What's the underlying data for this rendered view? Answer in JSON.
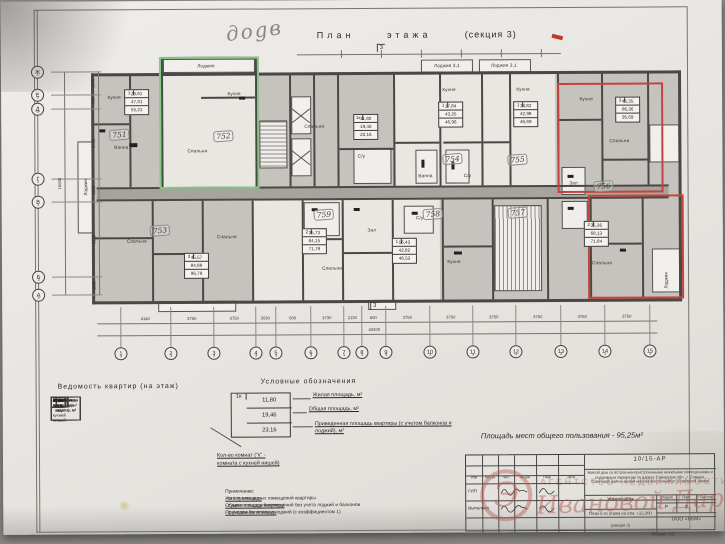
{
  "photo": {
    "handwritten_mark": "доgв"
  },
  "title": {
    "main": "План этажа",
    "section": "(секция 3)"
  },
  "plan": {
    "axis_sub": "3",
    "section_mark": "3",
    "room_labels": [
      {
        "x": 113,
        "y": 96,
        "t": "Кухня"
      },
      {
        "x": 205,
        "y": 65,
        "t": "Лоджия"
      },
      {
        "x": 233,
        "y": 93,
        "t": "Кухня"
      },
      {
        "x": 196,
        "y": 150,
        "t": "Спальня"
      },
      {
        "x": 313,
        "y": 126,
        "t": "Спальня"
      },
      {
        "x": 446,
        "y": 66,
        "t": "Лоджия 3,1"
      },
      {
        "x": 503,
        "y": 66,
        "t": "Лоджия 3,1"
      },
      {
        "x": 448,
        "y": 90,
        "t": "Кухня"
      },
      {
        "x": 522,
        "y": 90,
        "t": "Кухня"
      },
      {
        "x": 585,
        "y": 100,
        "t": "Кухня"
      },
      {
        "x": 618,
        "y": 142,
        "t": "Спальня"
      },
      {
        "x": 572,
        "y": 184,
        "t": "Зал"
      },
      {
        "x": 120,
        "y": 146,
        "t": "Ванна"
      },
      {
        "x": 360,
        "y": 156,
        "t": "С/у"
      },
      {
        "x": 424,
        "y": 176,
        "t": "Ванна"
      },
      {
        "x": 466,
        "y": 176,
        "t": "С/у"
      },
      {
        "x": 135,
        "y": 240,
        "t": "Спальня"
      },
      {
        "x": 225,
        "y": 236,
        "t": "Спальня"
      },
      {
        "x": 330,
        "y": 268,
        "t": "Спальня"
      },
      {
        "x": 452,
        "y": 262,
        "t": "Кухня"
      },
      {
        "x": 418,
        "y": 218,
        "t": "С/у"
      },
      {
        "x": 600,
        "y": 264,
        "t": "Спальня"
      },
      {
        "x": 370,
        "y": 230,
        "t": "Зал"
      },
      {
        "x": 664,
        "y": 282,
        "t": "Лоджия",
        "v": 1
      },
      {
        "x": 84,
        "y": 186,
        "t": "Лоджия",
        "v": 1
      }
    ],
    "unit_boxes": [
      {
        "x": 123,
        "y": 88,
        "k": "1",
        "rows": [
          "23,61",
          "47,31",
          "55,21"
        ]
      },
      {
        "x": 352,
        "y": 114,
        "k": "1к",
        "rows": [
          "11,80",
          "19,46",
          "23,16"
        ]
      },
      {
        "x": 437,
        "y": 102,
        "k": "1",
        "rows": [
          "17,84",
          "43,25",
          "46,96"
        ]
      },
      {
        "x": 512,
        "y": 102,
        "k": "1",
        "rows": [
          "16,82",
          "42,98",
          "46,69"
        ]
      },
      {
        "x": 614,
        "y": 98,
        "k": "3",
        "rows": [
          "45,35",
          "86,36",
          "95,69"
        ]
      },
      {
        "x": 300,
        "y": 228,
        "k": "2",
        "rows": [
          "35,73",
          "64,15",
          "71,78"
        ]
      },
      {
        "x": 390,
        "y": 238,
        "k": "1",
        "rows": [
          "16,43",
          "42,82",
          "46,53"
        ]
      },
      {
        "x": 582,
        "y": 222,
        "k": "2",
        "rows": [
          "35,36",
          "68,13",
          "71,84"
        ]
      },
      {
        "x": 182,
        "y": 252,
        "k": "3",
        "rows": [
          "45,57",
          "84,88",
          "96,79"
        ]
      }
    ],
    "handwritten_numbers": [
      {
        "x": 108,
        "y": 128,
        "t": "751"
      },
      {
        "x": 212,
        "y": 130,
        "t": "752"
      },
      {
        "x": 148,
        "y": 224,
        "t": "753"
      },
      {
        "x": 441,
        "y": 154,
        "t": "754"
      },
      {
        "x": 506,
        "y": 155,
        "t": "755"
      },
      {
        "x": 592,
        "y": 182,
        "t": "756"
      },
      {
        "x": 506,
        "y": 208,
        "t": "757"
      },
      {
        "x": 421,
        "y": 209,
        "t": "758"
      },
      {
        "x": 312,
        "y": 209,
        "t": "759"
      }
    ],
    "axis_bottom": [
      {
        "x": 118,
        "l": "1"
      },
      {
        "x": 168,
        "l": "2"
      },
      {
        "x": 211,
        "l": "3"
      },
      {
        "x": 253,
        "l": "4"
      },
      {
        "x": 273,
        "l": "5"
      },
      {
        "x": 308,
        "l": "6"
      },
      {
        "x": 341,
        "l": "7"
      },
      {
        "x": 359,
        "l": "8"
      },
      {
        "x": 383,
        "l": "9"
      },
      {
        "x": 427,
        "l": "10"
      },
      {
        "x": 470,
        "l": "11"
      },
      {
        "x": 513,
        "l": "12"
      },
      {
        "x": 558,
        "l": "13"
      },
      {
        "x": 602,
        "l": "14"
      },
      {
        "x": 647,
        "l": "15"
      }
    ],
    "dims_bottom": [
      "4140",
      "3750",
      "3750",
      "3030",
      "600",
      "3730",
      "2130",
      "600",
      "3750",
      "3750",
      "3750",
      "3750",
      "3750",
      "3750"
    ],
    "dims_total_bottom": "43200",
    "axis_left": [
      {
        "y": 70,
        "l": "Ж"
      },
      {
        "y": 93,
        "l": "Е"
      },
      {
        "y": 107,
        "l": "Д"
      },
      {
        "y": 177,
        "l": "Г"
      },
      {
        "y": 200,
        "l": "В"
      },
      {
        "y": 275,
        "l": "Б"
      },
      {
        "y": 293,
        "l": "А"
      }
    ],
    "dims_left": [
      "1070",
      "700",
      "5750",
      "1100",
      "6120",
      "1000"
    ],
    "dims_total_left": "16600"
  },
  "apartment_table": {
    "title": "Ведомость квартир (на этаж)",
    "headers": [
      "Тип квартиры",
      "Кол-во, шт.",
      "Жилая площадь, м²",
      "Общая площадь квартир, м²",
      "Приведенная площадь квартир, м²"
    ],
    "groups": [
      {
        "type": "1-комн.",
        "qty": "4",
        "rows": [
          [
            "23,61",
            "47,31",
            "55,21"
          ],
          [
            "17,84",
            "43,25",
            "46,96"
          ],
          [
            "16,82",
            "42,98",
            "46,69"
          ],
          [
            "16,43",
            "42,82",
            "46,53"
          ]
        ]
      },
      {
        "type": "1-комн. с кухней нишей",
        "qty": "1",
        "rows": [
          [
            "11,80",
            "19,46",
            "23,16"
          ]
        ]
      },
      {
        "type": "2х-комн.",
        "qty": "2",
        "rows": [
          [
            "35,36",
            "68,13",
            "71,84"
          ],
          [
            "35,73",
            "64,15",
            "71,78"
          ]
        ]
      },
      {
        "type": "3х-комн.",
        "qty": "2",
        "rows": [
          [
            "45,57",
            "84,88",
            "96,79"
          ],
          [
            "45,35",
            "86,36",
            "95,69"
          ]
        ]
      }
    ],
    "total": {
      "type": "ИТОГО на этаж",
      "qty": "9",
      "row": [
        "256,85",
        "498,93",
        "559,97"
      ]
    }
  },
  "legend": {
    "title": "Условные обозначения",
    "sample": {
      "k": "1к",
      "rows": [
        "11,80",
        "19,46",
        "23,16"
      ]
    },
    "labels": [
      "Жилая площадь, м²",
      "Общая площадь, м²",
      "Приведенная площадь квартиры (с учетом балконов и лоджий), м²"
    ],
    "rooms_note_1": "Кол-во комнат (\"к\" -",
    "rooms_note_2": "комната с кухней нишей)"
  },
  "notes": {
    "title": "Примечание:",
    "lines": [
      {
        "u": "Жилая площадь",
        "rest": " - это сумма жилых помещений квартиры"
      },
      {
        "u": "Общая площадь квартиры",
        "rest": " - сумма площадей помещений без учета лоджий и балконов"
      },
      {
        "u": "Приведенная площадь",
        "rest": " - с учетом балконов и лоджий (с коэффициентом 1)"
      }
    ]
  },
  "common_area": "Площадь мест общего пользования - 95,25м²",
  "title_block": {
    "code": "10/15-АР",
    "description": "Жилой дом со встроенно-пристроенными нежилыми помещениями и подземным паркингом по адресу Самарская обл., г. Самара, Советский район, жилой массив Восточный/ул. Советской Армии",
    "columns": [
      "Изм",
      "Кол.уч",
      "Лист",
      "№ док",
      "Подп",
      "Дата"
    ],
    "row_gip": "ГИП",
    "row_exec": "Выполнил",
    "object": "Жилой дом",
    "sheet_title": "План 5-го этажа на отм. +12,300",
    "sheet_section": "(секция 3)",
    "stage_label": "Стадия",
    "sheet_label": "Лист",
    "sheets_label": "Листов",
    "stage": "Р",
    "sheet_no": "8",
    "org": "ООО «ВБМ»",
    "format": "Формат А2"
  },
  "watermark": {
    "logo_letter": "Э",
    "caps": "АГЕНТСТВО НЕДВИЖИМОСТИ",
    "script": "Ивановой Дарии"
  }
}
